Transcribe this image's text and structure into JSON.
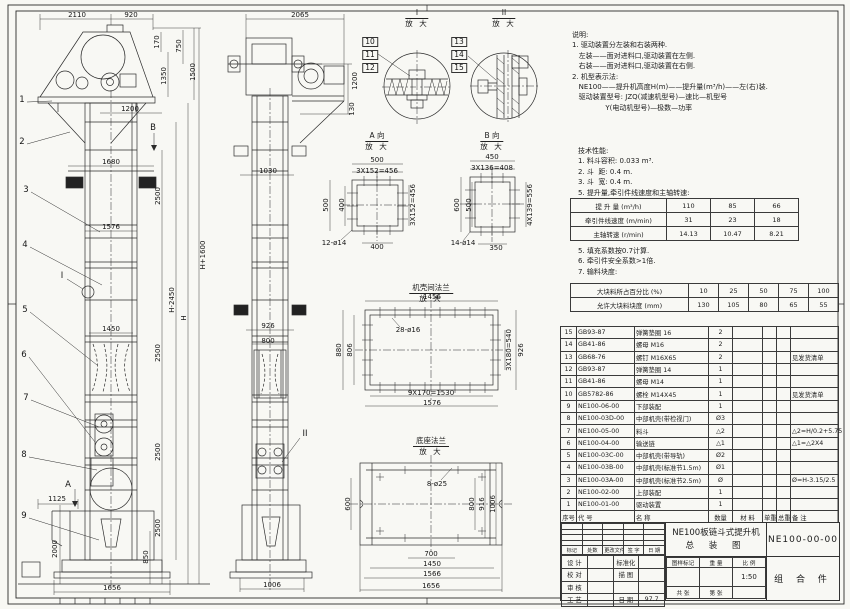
{
  "sheet": {
    "line_color": "#2b2b2b",
    "paper_color": "#f8f8f4"
  },
  "labels": [
    {
      "t": "2110",
      "x": 77,
      "y": 15
    },
    {
      "t": "920",
      "x": 131,
      "y": 15
    },
    {
      "t": "170",
      "x": 157,
      "y": 42,
      "r": 1
    },
    {
      "t": "750",
      "x": 179,
      "y": 46,
      "r": 1
    },
    {
      "t": "1350",
      "x": 164,
      "y": 76,
      "r": 1
    },
    {
      "t": "1500",
      "x": 193,
      "y": 72,
      "r": 1
    },
    {
      "t": "1200",
      "x": 130,
      "y": 109
    },
    {
      "t": "B",
      "x": 153,
      "y": 128,
      "c": "b"
    },
    {
      "t": "1680",
      "x": 111,
      "y": 162
    },
    {
      "t": "2500",
      "x": 158,
      "y": 196,
      "r": 1
    },
    {
      "t": "1576",
      "x": 111,
      "y": 227
    },
    {
      "t": "H-2450",
      "x": 172,
      "y": 300,
      "r": 1
    },
    {
      "t": "H",
      "x": 184,
      "y": 318,
      "r": 1
    },
    {
      "t": "H+1600",
      "x": 203,
      "y": 255,
      "r": 1
    },
    {
      "t": "1450",
      "x": 111,
      "y": 329
    },
    {
      "t": "2500",
      "x": 158,
      "y": 353,
      "r": 1
    },
    {
      "t": "2500",
      "x": 158,
      "y": 452,
      "r": 1
    },
    {
      "t": "2500",
      "x": 158,
      "y": 528,
      "r": 1
    },
    {
      "t": "1125",
      "x": 57,
      "y": 499
    },
    {
      "t": "2000",
      "x": 55,
      "y": 549,
      "r": 1
    },
    {
      "t": "850",
      "x": 146,
      "y": 557,
      "r": 1
    },
    {
      "t": "1656",
      "x": 112,
      "y": 588
    },
    {
      "t": "1",
      "x": 22,
      "y": 100,
      "c": "b"
    },
    {
      "t": "2",
      "x": 22,
      "y": 142,
      "c": "b"
    },
    {
      "t": "3",
      "x": 26,
      "y": 190,
      "c": "b"
    },
    {
      "t": "4",
      "x": 25,
      "y": 245,
      "c": "b"
    },
    {
      "t": "I",
      "x": 62,
      "y": 276,
      "c": "b"
    },
    {
      "t": "5",
      "x": 25,
      "y": 310,
      "c": "b"
    },
    {
      "t": "6",
      "x": 24,
      "y": 355,
      "c": "b"
    },
    {
      "t": "7",
      "x": 26,
      "y": 398,
      "c": "b"
    },
    {
      "t": "8",
      "x": 24,
      "y": 455,
      "c": "b"
    },
    {
      "t": "A",
      "x": 68,
      "y": 485,
      "c": "b"
    },
    {
      "t": "9",
      "x": 24,
      "y": 516,
      "c": "b"
    },
    {
      "t": "2065",
      "x": 300,
      "y": 15
    },
    {
      "t": "1200",
      "x": 355,
      "y": 81,
      "r": 1
    },
    {
      "t": "130",
      "x": 352,
      "y": 109,
      "r": 1
    },
    {
      "t": "1030",
      "x": 268,
      "y": 171
    },
    {
      "t": "926",
      "x": 268,
      "y": 326
    },
    {
      "t": "800",
      "x": 268,
      "y": 341
    },
    {
      "t": "II",
      "x": 305,
      "y": 434,
      "c": "b"
    },
    {
      "t": "1006",
      "x": 272,
      "y": 585
    },
    {
      "t": "10",
      "x": 370,
      "y": 42,
      "c": "box"
    },
    {
      "t": "11",
      "x": 370,
      "y": 55,
      "c": "box"
    },
    {
      "t": "12",
      "x": 370,
      "y": 68,
      "c": "box"
    },
    {
      "t": "13",
      "x": 459,
      "y": 42,
      "c": "box"
    },
    {
      "t": "14",
      "x": 459,
      "y": 55,
      "c": "box"
    },
    {
      "t": "15",
      "x": 459,
      "y": 68,
      "c": "box"
    },
    {
      "t": "500",
      "x": 377,
      "y": 160
    },
    {
      "t": "3X152=456",
      "x": 377,
      "y": 171
    },
    {
      "t": "500",
      "x": 326,
      "y": 205,
      "r": 1
    },
    {
      "t": "400",
      "x": 342,
      "y": 205,
      "r": 1
    },
    {
      "t": "3X152=456",
      "x": 413,
      "y": 205,
      "r": 1
    },
    {
      "t": "12-ø14",
      "x": 334,
      "y": 243
    },
    {
      "t": "400",
      "x": 377,
      "y": 247
    },
    {
      "t": "450",
      "x": 492,
      "y": 157
    },
    {
      "t": "3X136=408",
      "x": 492,
      "y": 168
    },
    {
      "t": "600",
      "x": 457,
      "y": 205,
      "r": 1
    },
    {
      "t": "500",
      "x": 469,
      "y": 205,
      "r": 1
    },
    {
      "t": "4X139=556",
      "x": 530,
      "y": 205,
      "r": 1
    },
    {
      "t": "14-ø14",
      "x": 463,
      "y": 243
    },
    {
      "t": "350",
      "x": 496,
      "y": 248
    },
    {
      "t": "1456",
      "x": 432,
      "y": 297
    },
    {
      "t": "28-ø16",
      "x": 408,
      "y": 330
    },
    {
      "t": "880",
      "x": 339,
      "y": 350,
      "r": 1
    },
    {
      "t": "806",
      "x": 350,
      "y": 350,
      "r": 1
    },
    {
      "t": "3X180=540",
      "x": 509,
      "y": 350,
      "r": 1
    },
    {
      "t": "926",
      "x": 521,
      "y": 350,
      "r": 1
    },
    {
      "t": "9X170=1530",
      "x": 431,
      "y": 393
    },
    {
      "t": "1576",
      "x": 432,
      "y": 403
    },
    {
      "t": "8-ø25",
      "x": 437,
      "y": 484
    },
    {
      "t": "600",
      "x": 348,
      "y": 504,
      "r": 1
    },
    {
      "t": "800",
      "x": 472,
      "y": 504,
      "r": 1
    },
    {
      "t": "916",
      "x": 482,
      "y": 504,
      "r": 1
    },
    {
      "t": "1006",
      "x": 493,
      "y": 504,
      "r": 1
    },
    {
      "t": "700",
      "x": 431,
      "y": 554
    },
    {
      "t": "1450",
      "x": 432,
      "y": 564
    },
    {
      "t": "1566",
      "x": 432,
      "y": 574
    },
    {
      "t": "1656",
      "x": 431,
      "y": 586
    }
  ],
  "vtitles": [
    {
      "top": "I",
      "bottom": "放 大",
      "x": 417,
      "y": 8
    },
    {
      "top": "II",
      "bottom": "放 大",
      "x": 504,
      "y": 8
    },
    {
      "top": "A 向",
      "bottom": "放 大",
      "x": 377,
      "y": 131
    },
    {
      "top": "B 向",
      "bottom": "放 大",
      "x": 492,
      "y": 131
    },
    {
      "top": "机壳间法兰",
      "bottom": "放 大",
      "x": 431,
      "y": 283
    },
    {
      "top": "底座法兰",
      "bottom": "放 大",
      "x": 431,
      "y": 436
    }
  ],
  "notes": {
    "block1": [
      "说明:",
      "1. 驱动装置分左装和右装两种.",
      "   左装——面对进料口,驱动装置在左侧.",
      "   右装——面对进料口,驱动装置在右侧.",
      "2. 机型表示法:",
      "   NE100——提升机高度H(m)——提升量(m³/h)——左(右)装.",
      "   驱动装置型号: JZQ(减速机型号)—速比—机型号",
      "               Y(电动机型号)—极数—功率"
    ],
    "block2": [
      "技术性能:",
      "1. 料斗容积: 0.033 m³.",
      "2. 斗  距: 0.4 m.",
      "3. 斗  宽: 0.4 m.",
      "5. 提升量,牵引件线速度和主轴转速:"
    ],
    "block3": [
      "5. 填充系数按0.7计算.",
      "6. 牵引件安全系数>1倍.",
      "7. 输料块度:"
    ]
  },
  "spec1": {
    "rows": [
      [
        "提 升 量 (m³/h)",
        "110",
        "85",
        "66"
      ],
      [
        "牵引件线速度 (m/min)",
        "31",
        "23",
        "18"
      ],
      [
        "主轴转速 (r/min)",
        "14.13",
        "10.47",
        "8.21"
      ]
    ]
  },
  "spec2": {
    "rows": [
      [
        "大块料所占百分比 (%)",
        "10",
        "25",
        "50",
        "75",
        "100"
      ],
      [
        "允许大块料块度 (mm)",
        "130",
        "105",
        "80",
        "65",
        "55"
      ]
    ]
  },
  "bom": {
    "rows": [
      [
        "15",
        "GB93-87",
        "弹簧垫圈 16",
        "2",
        "",
        "",
        "",
        ""
      ],
      [
        "14",
        "GB41-86",
        "螺母 M16",
        "2",
        "",
        "",
        "",
        ""
      ],
      [
        "13",
        "GB68-76",
        "螺钉 M16X65",
        "2",
        "",
        "",
        "",
        "见发货清单"
      ],
      [
        "12",
        "GB93-87",
        "弹簧垫圈 14",
        "1",
        "",
        "",
        "",
        ""
      ],
      [
        "11",
        "GB41-86",
        "螺母 M14",
        "1",
        "",
        "",
        "",
        ""
      ],
      [
        "10",
        "GB5782-86",
        "螺栓 M14X45",
        "1",
        "",
        "",
        "",
        "见发货清单"
      ],
      [
        "9",
        "NE100-06-00",
        "下部装配",
        "1",
        "",
        "",
        "",
        ""
      ],
      [
        "8",
        "NE100-03D-00",
        "中部机壳(带检视门)",
        "Ø3",
        "",
        "",
        "",
        ""
      ],
      [
        "7",
        "NE100-05-00",
        "料斗",
        "△2",
        "",
        "",
        "",
        "△2=H/0.2+5.75"
      ],
      [
        "6",
        "NE100-04-00",
        "输送链",
        "△1",
        "",
        "",
        "",
        "△1=△2X4"
      ],
      [
        "5",
        "NE100-03C-00",
        "中部机壳(带导轨)",
        "Ø2",
        "",
        "",
        "",
        ""
      ],
      [
        "4",
        "NE100-03B-00",
        "中部机壳(标准节1.5m)",
        "Ø1",
        "",
        "",
        "",
        ""
      ],
      [
        "3",
        "NE100-03A-00",
        "中部机壳(标准节2.5m)",
        "Ø",
        "",
        "",
        "",
        "Ø=H-3.15/2.5"
      ],
      [
        "2",
        "NE100-02-00",
        "上部装配",
        "1",
        "",
        "",
        "",
        ""
      ],
      [
        "1",
        "NE100-01-00",
        "驱动装置",
        "1",
        "",
        "",
        "",
        ""
      ],
      [
        "序号",
        "代  号",
        "名  称",
        "数量",
        "材  料",
        "单重",
        "总重",
        "备  注"
      ]
    ]
  },
  "titleblock": {
    "title1": "NE100板链斗式提升机",
    "title2": "总 装 图",
    "dwg_no": "NE100-00-00",
    "part": "组 合 件",
    "rev_rows": [
      [
        "",
        "",
        "",
        "",
        ""
      ],
      [
        "",
        "",
        "",
        "",
        ""
      ],
      [
        "",
        "",
        "",
        "",
        ""
      ],
      [
        "",
        "",
        "",
        "",
        ""
      ],
      [
        "标记",
        "处数",
        "更改文件号",
        "签 字",
        "日 期"
      ]
    ],
    "sign_rows": [
      [
        "设 计",
        "",
        "标准化",
        ""
      ],
      [
        "校 对",
        "",
        "描 图",
        ""
      ],
      [
        "审 核",
        "",
        "",
        ""
      ],
      [
        "工 艺",
        "",
        "日 期",
        "97.7"
      ]
    ],
    "mid_rows": [
      [
        "图样标记",
        "重 量",
        "比 例"
      ],
      [
        "",
        "",
        "1:50"
      ],
      [
        "共  张",
        "第  张",
        ""
      ]
    ]
  }
}
